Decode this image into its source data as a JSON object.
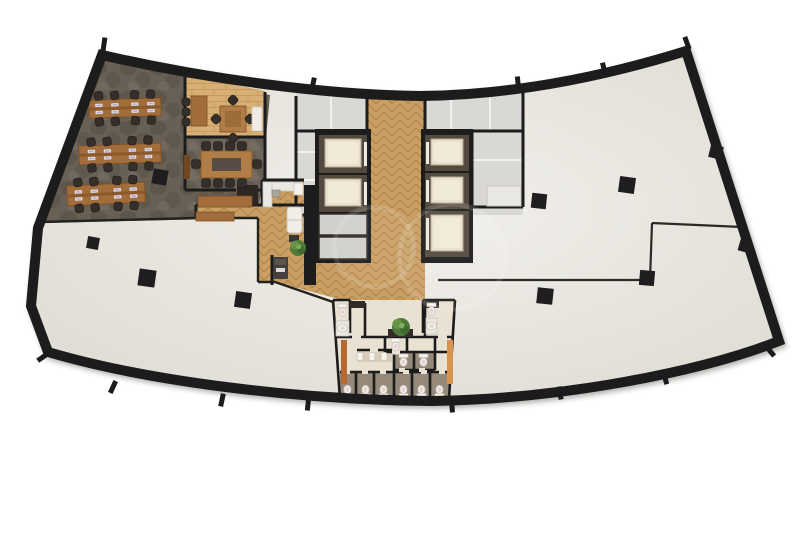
{
  "scene": {
    "width": 802,
    "height": 535,
    "bg": "#ffffff",
    "description": "curved office tower floor plan rendering"
  },
  "colors": {
    "wall": "#1b1a1c",
    "wall_thin": "#23211f",
    "wall_se": "#2b2927",
    "floor_light": "#f2f0eb",
    "floor_dark": "#ddd9d2",
    "carpet": "#696055",
    "carpet_conf": "#6e655a",
    "wood_base": "#c99f63",
    "wood_line": "#b2854a",
    "plank_base": "#d7ae73",
    "plank_line": "#c59c60",
    "gray_room": "#dad8d4",
    "white_wall": "#f2f1ef",
    "desk_wood": "#a16d3a",
    "desk_edge": "#7c5026",
    "desk_strip": "#8a5a2c",
    "table_wood": "#b07d46",
    "table_inner": "#584e44",
    "chair": "#352f29",
    "monitor": "#efeef3",
    "monitor_screen": "#b9a8cc",
    "cab_frame": "#52483e",
    "cab_floor": "#e9dfcc",
    "cab_hi": "#f2ead8",
    "cab_door": "#efe9dd",
    "panel": "#d2d0cc",
    "restroom_floor": "#e9e1d1",
    "stall_floor": "#96897a",
    "urinal_strip": "#d8cdb9",
    "fixture": "#f6f3ee",
    "fixture_edge": "#c9c2b4",
    "fixture_lid": "#e9d3da",
    "counter_dark": "#332c26",
    "accent_a": "#b46a33",
    "accent_b": "#d99250",
    "closet": "#2d2723",
    "sofa": "#f1eee8",
    "sofa_edge": "#c9c4ba",
    "plant_a": "#4f7a38",
    "plant_b": "#659447",
    "plant_c": "#3f6b2e",
    "copier": "#45403c",
    "copier_top": "#5a554f",
    "counter_white": "#eae8e2",
    "watermark_stroke": "rgba(255,255,255,0.13)",
    "watermark_fill": "rgba(255,255,255,0.06)"
  },
  "building": {
    "outline_path": "M102,55 C210,80 330,95 420,96 C520,95 612,74 686,51 L779,341 C700,372 562,399 432,401 C300,400 150,382 48,352 L31,306 L38,228 Z",
    "wall_stroke": 10
  },
  "floors": {
    "carpet_poly": "M103,58 L270,95 L262,180 L258,218 L40,223 Z",
    "office_poly": "M185,74 L265,91 L265,137 L185,137 Z",
    "conference_rect": [
      185,
      137,
      80,
      53
    ],
    "pantry_rect": [
      262,
      180,
      42,
      27
    ],
    "core_gray_rect": [
      296,
      90,
      227,
      125
    ],
    "wood_corridor_top": [
      367,
      92,
      58,
      41
    ],
    "wood_between_banks": [
      369,
      131,
      53,
      131
    ],
    "wood_lounge_poly": "M196,205 L425,205 L425,300 L423,300 L423,333 L350,333 L350,302 L275,282 L258,282 L258,218 L196,218 Z",
    "restroom_poly": "M333,300 L455,300 L449,399 L340,399 Z",
    "stall_rects": [
      [
        340,
        372,
        54,
        27
      ],
      [
        394,
        372,
        55,
        27
      ],
      [
        394,
        352,
        41,
        18
      ]
    ],
    "urinal_strip_rect": [
      357,
      351,
      35,
      11
    ]
  },
  "walls": {
    "black": [
      "M185,77 L185,190",
      "M185,137 L265,137",
      "M265,92 L265,190",
      "M185,190 L236,190",
      "M248,190 L265,190",
      "M196,205 L304,205",
      "M196,205 L196,218",
      "M262,180 L304,180",
      "M262,180 L262,205",
      "M367,92 L367,131",
      "M425,92 L425,131",
      "M296,131 L367,131",
      "M425,131 L523,131",
      "M523,90 L523,207",
      "M472,207 L523,207",
      "M472,131 L472,207",
      "M296,96 L296,215",
      "M296,215 L316,215",
      "M272,255 L272,285"
    ],
    "boundary": [
      "M40,222 L196,218",
      "M196,218 L258,218",
      "M258,218 L258,282",
      "M258,282 L275,282",
      "M275,282 L333,302"
    ],
    "se": [
      "M438,280 L650,280",
      "M650,280 L652,223",
      "M652,223 L742,227"
    ],
    "white": [
      "M296,152 L316,152",
      "M296,180 L316,180",
      "M331,96 L331,131",
      "M451,95 L451,131",
      "M490,94 L490,131",
      "M472,160 L523,160"
    ],
    "restroom": [
      "M333,300 L350,300",
      "M423,300 L455,300",
      "M333,300 L340,399",
      "M455,300 L449,399",
      "M350,300 L350,333",
      "M423,300 L423,333",
      "M365,303 L365,337",
      "M425,302 L425,337",
      "M336,337 L453,337",
      "M385,337 L385,352",
      "M407,337 L407,352",
      "M357,350 L392,350",
      "M385,352 L453,352",
      "M394,352 L394,399",
      "M394,370 L435,370",
      "M414,352 L414,370",
      "M435,337 L435,370",
      "M340,372 L394,372",
      "M394,372 L449,372",
      "M356,372 L356,399",
      "M374,372 L374,399",
      "M412,372 L412,399",
      "M430,372 L430,399"
    ],
    "door_gaps": [
      [
        352,
        334.5,
        9,
        5
      ],
      [
        438,
        334.5,
        9,
        5
      ],
      [
        344,
        370,
        6,
        4
      ],
      [
        362,
        370,
        6,
        4
      ],
      [
        380,
        370,
        6,
        4
      ],
      [
        403,
        370,
        6,
        4
      ],
      [
        421,
        370,
        6,
        4
      ],
      [
        439,
        370,
        6,
        4
      ],
      [
        399,
        368,
        6,
        4
      ],
      [
        419,
        368,
        6,
        4
      ],
      [
        370,
        348.5,
        8,
        4
      ],
      [
        392,
        350.5,
        8,
        4
      ]
    ]
  },
  "core": {
    "west_wall_rect": [
      304,
      185,
      12,
      100
    ],
    "left_bank_rect": [
      315,
      129,
      56,
      134
    ],
    "right_bank_rect": [
      421,
      129,
      52,
      134
    ],
    "left_cabs": [
      [
        319,
        135,
        48,
        38
      ],
      [
        319,
        175,
        48,
        37
      ]
    ],
    "left_cab_door_x": 364,
    "right_cabs": [
      [
        425,
        135,
        44,
        36
      ],
      [
        425,
        173,
        44,
        36
      ],
      [
        425,
        211,
        44,
        46
      ]
    ],
    "right_cab_door_x": 426,
    "service_panels": [
      [
        319,
        214,
        48,
        21
      ],
      [
        319,
        237,
        48,
        22
      ]
    ],
    "se_counter_rect": [
      487,
      186,
      34,
      20
    ]
  },
  "restroom": {
    "urinals": [
      [
        360,
        352.5
      ],
      [
        372,
        352.5
      ],
      [
        384,
        352.5
      ]
    ],
    "toilets_tank_top": [
      [
        391,
        338.5
      ],
      [
        399,
        354
      ],
      [
        419,
        354
      ],
      [
        338,
        304
      ],
      [
        427,
        303
      ]
    ],
    "toilets_tank_bottom": [
      [
        343,
        385
      ],
      [
        361,
        385
      ],
      [
        379,
        385
      ],
      [
        399,
        385
      ],
      [
        417,
        385
      ],
      [
        435,
        385
      ]
    ],
    "sink_counters": [
      [
        336,
        321,
        13,
        15
      ],
      [
        426,
        318,
        11,
        16
      ]
    ],
    "basins": [
      [
        342.5,
        328,
        5,
        4
      ],
      [
        431.5,
        326,
        5,
        4
      ]
    ],
    "dark_counters": [
      [
        350,
        301,
        15,
        7
      ],
      [
        423,
        301,
        16,
        7
      ]
    ],
    "plant_counter": [
      388,
      329,
      25,
      8
    ],
    "plant": [
      401,
      327,
      9
    ],
    "accent_strips": [
      [
        341,
        340,
        6,
        44
      ],
      [
        447,
        340,
        6,
        44
      ]
    ]
  },
  "open_office": {
    "benches": [
      {
        "cx": 125,
        "cy": 108,
        "w": 72,
        "h": 18,
        "rot": -2
      },
      {
        "cx": 120,
        "cy": 154,
        "w": 82,
        "h": 19,
        "rot": -2
      },
      {
        "cx": 106,
        "cy": 194,
        "w": 78,
        "h": 20,
        "rot": -3
      }
    ],
    "bench_layout": {
      "pod_dx": [
        -18,
        18
      ],
      "chair_offsets": [
        [
          -8,
          -13
        ],
        [
          8,
          -13
        ],
        [
          -8,
          13
        ],
        [
          8,
          13
        ]
      ],
      "monitor_offsets": [
        [
          -8,
          -3.5
        ],
        [
          8,
          -3.5
        ],
        [
          -8,
          3.5
        ],
        [
          8,
          3.5
        ]
      ]
    },
    "floor_column": [
      160,
      177,
      15,
      10
    ]
  },
  "office_room": {
    "desk": [
      191,
      96,
      16,
      30
    ],
    "desk_chairs": [
      [
        186,
        102
      ],
      [
        186,
        112
      ],
      [
        186,
        122
      ]
    ],
    "table": [
      220,
      106,
      26,
      26
    ],
    "table_chairs": [
      [
        233,
        100
      ],
      [
        250,
        119
      ],
      [
        233,
        138
      ],
      [
        216,
        119
      ]
    ],
    "white_bench": [
      252,
      107,
      10,
      24
    ]
  },
  "conference_room": {
    "table": [
      201,
      151,
      51,
      27
    ],
    "table_inner": [
      212,
      158,
      29,
      13
    ],
    "chairs": [
      [
        206,
        146
      ],
      [
        218,
        146
      ],
      [
        230,
        146
      ],
      [
        242,
        146
      ],
      [
        206,
        183
      ],
      [
        218,
        183
      ],
      [
        230,
        183
      ],
      [
        242,
        183
      ],
      [
        196,
        164
      ],
      [
        257,
        164
      ]
    ],
    "cabinet": [
      184,
      155,
      6,
      24
    ],
    "sideboards": [
      [
        198,
        196,
        54,
        11
      ],
      [
        196,
        212,
        38,
        9
      ]
    ]
  },
  "lounge": {
    "sofa": [
      287,
      207,
      15,
      26
    ],
    "side_table": [
      289,
      235,
      10,
      7
    ],
    "plant": [
      298,
      248,
      8
    ],
    "copier": [
      273,
      257,
      15,
      22
    ],
    "closet_rect": [
      237,
      185,
      21,
      20
    ],
    "pantry_counter_h": [
      263,
      182,
      39,
      9
    ],
    "pantry_counter_v": [
      263,
      182,
      9,
      25
    ],
    "pantry_sink": [
      272,
      190,
      8,
      7
    ],
    "pantry_fridge": [
      294,
      183,
      9,
      12
    ]
  },
  "columns": [
    [
      160,
      177,
      15,
      10
    ],
    [
      147,
      278,
      17,
      8
    ],
    [
      243,
      300,
      16,
      8
    ],
    [
      545,
      296,
      16,
      6
    ],
    [
      539,
      201,
      15,
      6
    ],
    [
      627,
      185,
      16,
      8
    ],
    [
      647,
      278,
      15,
      5
    ],
    [
      716,
      152,
      13,
      14
    ],
    [
      745,
      246,
      12,
      16
    ],
    [
      93,
      243,
      12,
      10
    ]
  ],
  "wall_ticks": [
    [
      104,
      44,
      8
    ],
    [
      313,
      84,
      12
    ],
    [
      518,
      83,
      -6
    ],
    [
      604,
      69,
      -14
    ],
    [
      687,
      43,
      -20
    ],
    [
      43,
      357,
      55
    ],
    [
      113,
      387,
      25
    ],
    [
      222,
      400,
      12
    ],
    [
      308,
      404,
      6
    ],
    [
      452,
      406,
      -4
    ],
    [
      560,
      393,
      -10
    ],
    [
      665,
      378,
      -16
    ],
    [
      770,
      351,
      -40
    ]
  ],
  "watermark": {
    "circles": [
      [
        374,
        247,
        40
      ],
      [
        452,
        257,
        53
      ]
    ]
  }
}
